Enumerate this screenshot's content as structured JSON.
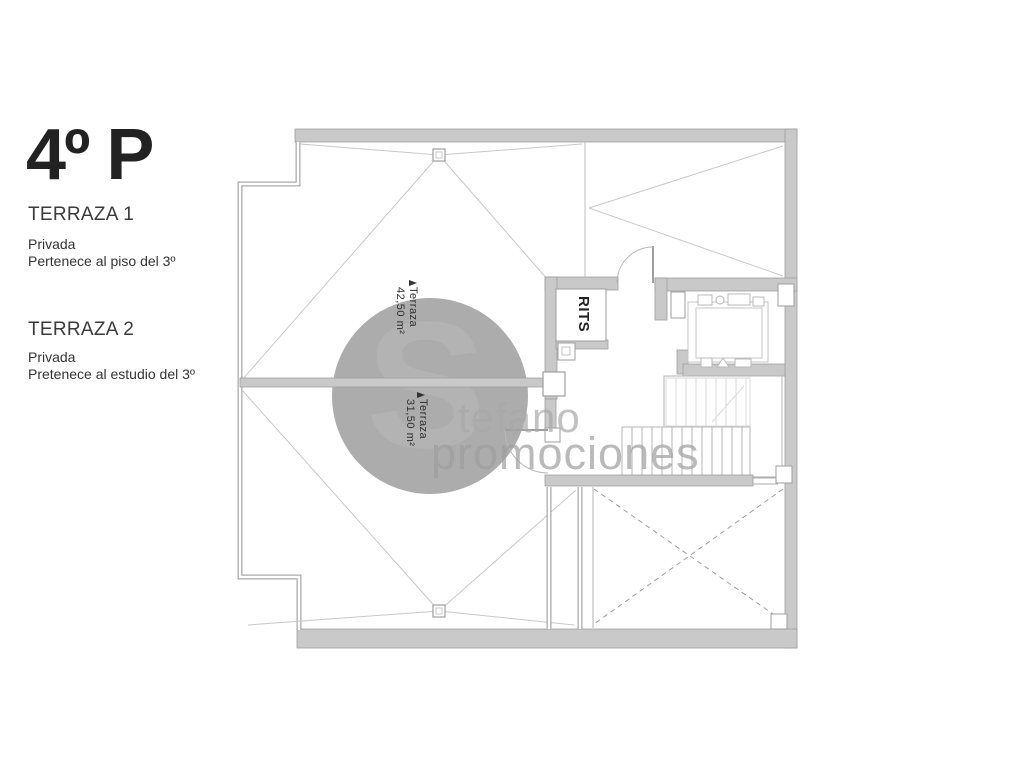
{
  "info_panel": {
    "title": "4º P",
    "sections": [
      {
        "heading": "TERRAZA 1",
        "lines": [
          "Privada",
          "Pertenece al piso del 3º"
        ]
      },
      {
        "heading": "TERRAZA 2",
        "lines": [
          "Privada",
          "Pretenece al estudio del 3º"
        ]
      }
    ]
  },
  "floor_plan": {
    "labels": {
      "rits": "RITS",
      "terraza1": [
        "Terraza",
        "42,50 m²"
      ],
      "terraza2": [
        "Terraza",
        "31,50 m²"
      ]
    },
    "colors": {
      "wall_fill": "#c9c9c9",
      "wall_edge": "#9e9e9e",
      "roof_line": "#c8c8c8",
      "label_text": "#2f2f2f"
    }
  },
  "watermark": {
    "initial": "S",
    "name_rest": "tefano",
    "word": "promociones",
    "color": "#9a9a9a"
  }
}
